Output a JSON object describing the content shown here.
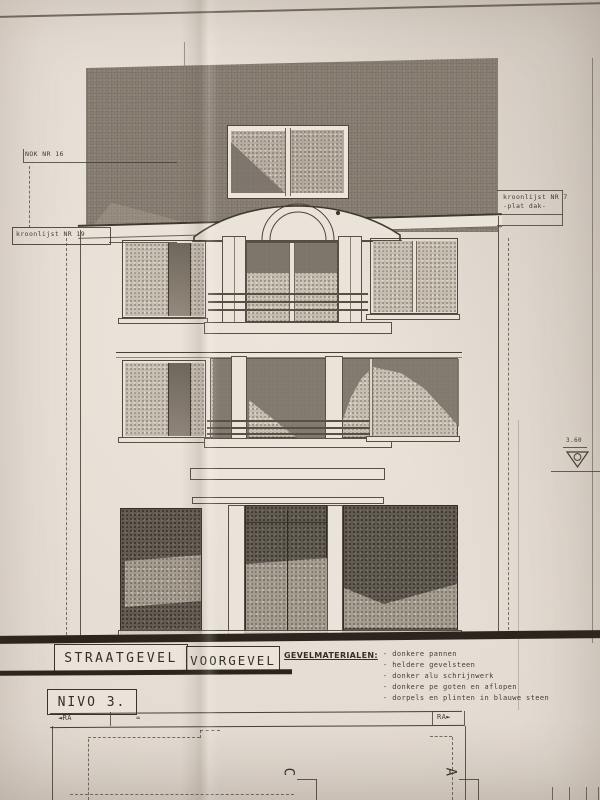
{
  "annotations": {
    "nok": "NOK NR 16",
    "kroonlijst_left": "kroonlijst NR 19",
    "kroonlijst_right": "kroonlijst NR 7",
    "kroonlijst_right_sub": "-plat dak-",
    "level_value": "3.60",
    "approx_mark": "≈"
  },
  "title_block": {
    "title_left": "STRAATGEVEL",
    "title_right": "VOORGEVEL",
    "materials_heading": "GEVELMATERIALEN:",
    "materials": [
      "- donkere pannen",
      "- heldere gevelsteen",
      "- donker alu schrijnwerk",
      "- donkere pe goten en aflopen",
      "- dorpels en plinten in blauwe steen"
    ],
    "nivo": "NIVO 3."
  },
  "plan_strip": {
    "ra_left": "RA",
    "ra_right": "RA",
    "arrow_left": "◄",
    "arrow_right": "►",
    "grid_letter_left": "C",
    "grid_letter_right": "A"
  },
  "colors": {
    "paper": "#e7dfd6",
    "ink": "#463f33",
    "roof": "#8b8175",
    "glass_light": "#c6bdb1",
    "glass_dark": "#625b52",
    "reflection": "#7e766a"
  }
}
